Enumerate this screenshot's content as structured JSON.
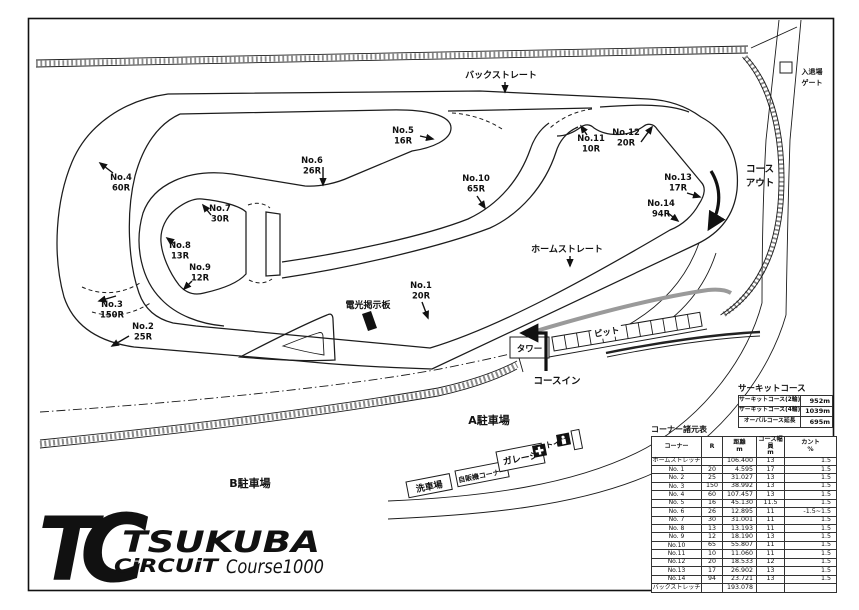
{
  "corners": [
    {
      "label": "No.1",
      "radius": "20R"
    },
    {
      "label": "No.2",
      "radius": "25R"
    },
    {
      "label": "No.3",
      "radius": "150R"
    },
    {
      "label": "No.4",
      "radius": "60R"
    },
    {
      "label": "No.5",
      "radius": "16R"
    },
    {
      "label": "No.6",
      "radius": "26R"
    },
    {
      "label": "No.7",
      "radius": "30R"
    },
    {
      "label": "No.8",
      "radius": "13R"
    },
    {
      "label": "No.9",
      "radius": "12R"
    },
    {
      "label": "No.10",
      "radius": "65R"
    },
    {
      "label": "No.11",
      "radius": "10R"
    },
    {
      "label": "No.12",
      "radius": "20R"
    },
    {
      "label": "No.13",
      "radius": "17R"
    },
    {
      "label": "No.14",
      "radius": "94R"
    }
  ],
  "landmarks": {
    "back_straight": "バックストレート",
    "home_straight": "ホームストレート",
    "course_in": "コースイン",
    "course_out_l1": "コース",
    "course_out_l2": "アウト",
    "gate_l1": "入退場",
    "gate_l2": "ゲート",
    "tower": "タワー",
    "pit": "ピット",
    "sign_board": "電光掲示板",
    "parking_a": "A駐車場",
    "parking_b": "B駐車場",
    "car_wash": "洗車場",
    "vending": "自販機コーナー",
    "garage": "ガレージ",
    "toilet": "トイレ"
  },
  "logo": {
    "t": "T",
    "c": "C",
    "name": "TSUKUBA",
    "sub": "CiRCUiT",
    "course": "Course1000"
  },
  "circuit_table": {
    "title": "サーキットコース",
    "rows": [
      [
        "サーキットコース(2輪)",
        "952m"
      ],
      [
        "サーキットコース(4輪)",
        "1039m"
      ],
      [
        "オーバルコース延長",
        "695m"
      ]
    ]
  },
  "corner_table": {
    "title": "コーナー諸元表",
    "headers": [
      {
        "l1": "コーナー",
        "l2": ""
      },
      {
        "l1": "R",
        "l2": ""
      },
      {
        "l1": "距離",
        "l2": "m"
      },
      {
        "l1": "コース幅員",
        "l2": "m"
      },
      {
        "l1": "カント",
        "l2": "%"
      }
    ],
    "rows": [
      [
        "ホームストレッチ",
        "",
        "106.400",
        "13",
        "1.5"
      ],
      [
        "No. 1",
        "20",
        "4.595",
        "17",
        "1.5"
      ],
      [
        "No. 2",
        "25",
        "31.027",
        "13",
        "1.5"
      ],
      [
        "No. 3",
        "150",
        "38.992",
        "13",
        "1.5"
      ],
      [
        "No. 4",
        "60",
        "107.457",
        "13",
        "1.5"
      ],
      [
        "No. 5",
        "16",
        "45.130",
        "11.5",
        "1.5"
      ],
      [
        "No. 6",
        "26",
        "12.895",
        "11",
        "-1.5~1.5"
      ],
      [
        "No. 7",
        "30",
        "31.001",
        "11",
        "1.5"
      ],
      [
        "No. 8",
        "13",
        "13.193",
        "11",
        "1.5"
      ],
      [
        "No. 9",
        "12",
        "18.190",
        "13",
        "1.5"
      ],
      [
        "No.10",
        "65",
        "55.807",
        "11",
        "1.5"
      ],
      [
        "No.11",
        "10",
        "11.060",
        "11",
        "1.5"
      ],
      [
        "No.12",
        "20",
        "18.533",
        "12",
        "1.5"
      ],
      [
        "No.13",
        "17",
        "26.902",
        "13",
        "1.5"
      ],
      [
        "No.14",
        "94",
        "23.721",
        "13",
        "1.5"
      ],
      [
        "バックストレッチ",
        "",
        "193.078",
        "",
        ""
      ]
    ]
  }
}
